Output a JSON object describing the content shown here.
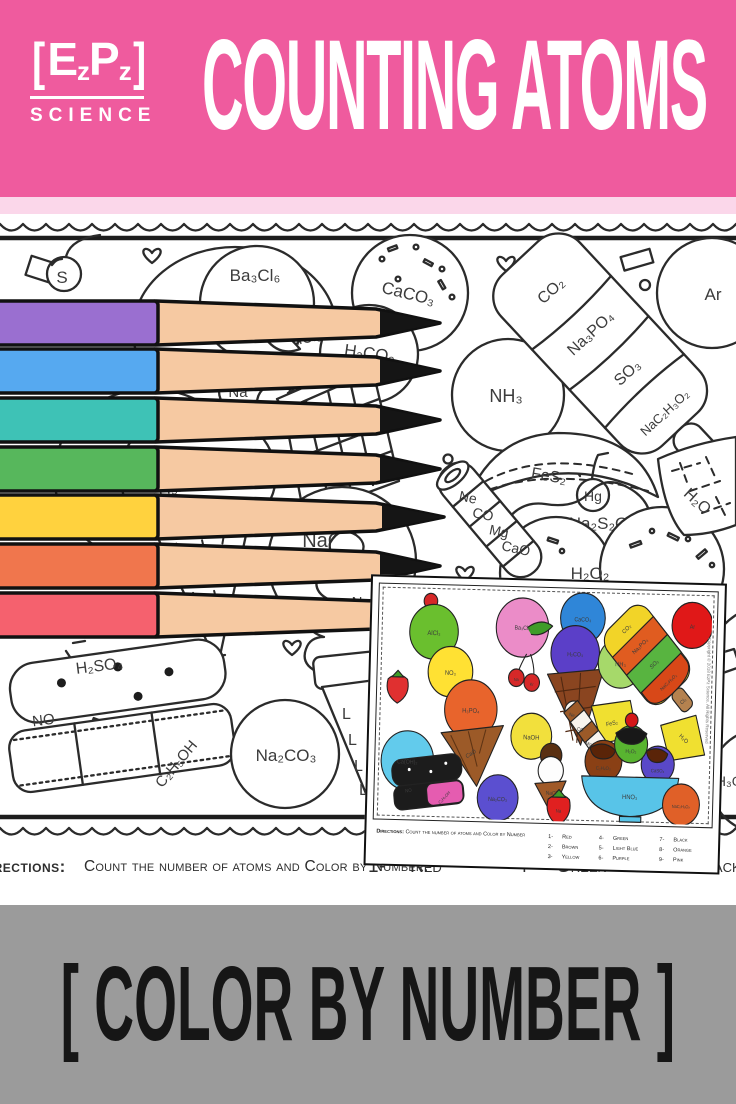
{
  "header": {
    "background": "#ef5b9e",
    "strip_color": "#fbd7ea",
    "logo": {
      "bracket_open": "[",
      "letter_e": "E",
      "sub_z1": "z",
      "letter_p": "P",
      "sub_z2": "z",
      "bracket_close": "]",
      "subtitle": "SCIENCE"
    },
    "title": "COUNTING ATOMS"
  },
  "worksheet": {
    "formulas": {
      "s": "S",
      "alcl3": "AlCl₃",
      "o3_fragment": "O₃",
      "ba3cl6": "Ba₃Cl₆",
      "na": "Na",
      "kr": "Kr",
      "h2co3": "H₂CO₃",
      "h2": "H₂",
      "caco3": "CaCO₃",
      "nh3": "NH₃",
      "co2": "CO₂",
      "na3po4": "Na₃PO₄",
      "so3": "SO₃",
      "nac2h3o2": "NaC₂H₃O₂",
      "cl2": "Cl₂",
      "ar": "Ar",
      "fes2": "FeS₂",
      "hg": "Hg",
      "na2s2o3": "Na₂S₂O₃",
      "ne": "Ne",
      "co": "CO",
      "mg": "Mg",
      "cao_wafer": "CaO",
      "h2o": "H₂O",
      "naoh": "NaOH",
      "h3po4": "H₃PO₄",
      "cao_cone": "CaO",
      "n2": "N₂",
      "h2o2": "H₂O₂",
      "h2so4": "H₂SO₄",
      "no": "NO",
      "c2h5oh": "C₂H₅OH",
      "na2co3": "Na₂CO₃",
      "h3o2_fragment": "H₃O₂"
    },
    "cone_mark": "L",
    "directions_label": "Directions:",
    "directions_text": "Count the number of atoms and Color by Number.",
    "key": [
      {
        "num": "1-",
        "color": "Red"
      },
      {
        "num": "4-",
        "color": "Green"
      },
      {
        "num": "7-",
        "color": "Black"
      }
    ]
  },
  "pencils": [
    {
      "name": "purple",
      "color": "#9a6fd0"
    },
    {
      "name": "blue",
      "color": "#56a9f0"
    },
    {
      "name": "teal",
      "color": "#3ec2b6"
    },
    {
      "name": "green",
      "color": "#57b75c"
    },
    {
      "name": "yellow",
      "color": "#ffd23e"
    },
    {
      "name": "orange",
      "color": "#f0764d"
    },
    {
      "name": "red",
      "color": "#f5616e"
    }
  ],
  "inset": {
    "labels": {
      "alcl3": "AlCl₃",
      "no3": "NO₃",
      "h3po4": "H₃PO₄",
      "cao": "CaO",
      "ba3cl6": "Ba₃Cl₆",
      "na": "Na",
      "kr": "Kr",
      "caoh2": "Ca(OH)₂",
      "caco3": "CaCO₃",
      "h2co3": "H₂CO₃",
      "naoh": "NaOH",
      "nacl": "NaCl",
      "nh3": "NH₃",
      "co2": "CO₂",
      "na3po4": "Na₃PO₄",
      "so3": "SO₃",
      "nac2h3o2": "NaC₂H₃O₂",
      "cl2": "Cl₂",
      "ar": "Ar",
      "fes2": "FeS₂",
      "h2o": "H₂O",
      "ne": "Ne",
      "co": "CO",
      "mg": "Mg",
      "h2o2": "H₂O₂",
      "hno3": "HNO₃",
      "c2h4o2": "C₂H₄O₂",
      "caso4": "CaSO₄",
      "no": "NO",
      "c2h5oh": "C₂H₅OH",
      "na2co3": "Na₂CO₃",
      "na_strawberry": "Na",
      "nac2h3o2_2": "NaC₂H₃O₂"
    },
    "directions_label": "Directions:",
    "directions_text": "Count the number of atoms and Color by Number",
    "key": [
      {
        "num": "1-",
        "color": "Red"
      },
      {
        "num": "2-",
        "color": "Brown"
      },
      {
        "num": "3-",
        "color": "Yellow"
      },
      {
        "num": "4-",
        "color": "Green"
      },
      {
        "num": "5-",
        "color": "Light Blue"
      },
      {
        "num": "6-",
        "color": "Purple"
      },
      {
        "num": "7-",
        "color": "Black"
      },
      {
        "num": "8-",
        "color": "Orange"
      },
      {
        "num": "9-",
        "color": "Pink"
      }
    ],
    "copyright": "Copyright © 2018 EzPz Science. All Rights Reserved"
  },
  "footer": {
    "background": "#9b9b9b",
    "text": "[ COLOR BY NUMBER ]"
  }
}
